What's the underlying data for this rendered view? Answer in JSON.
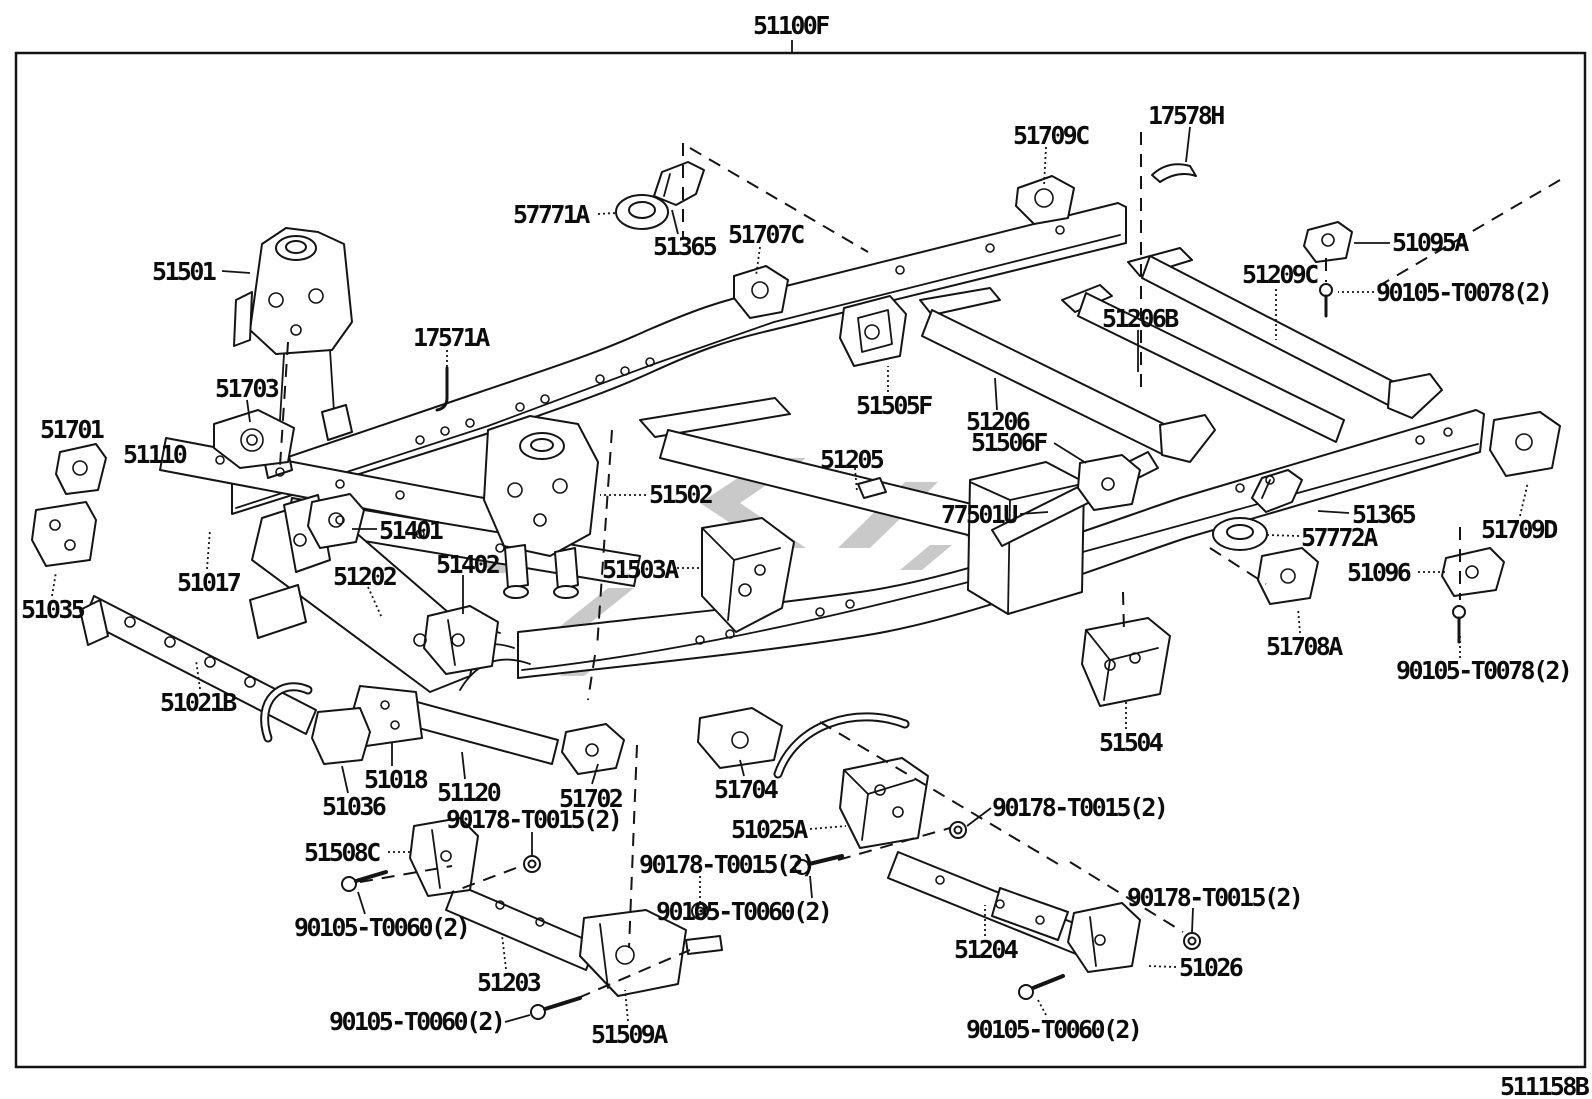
{
  "doc": {
    "assembly_label": "51100F",
    "sheet_code": "511158B",
    "type": "parts-diagram",
    "subject": "vehicle frame assembly exploded view"
  },
  "colors": {
    "line": "#141414",
    "background": "#ffffff",
    "watermark": "#c9c9c9"
  },
  "labels": [
    {
      "text": "17578H",
      "x": 1148,
      "y": 103
    },
    {
      "text": "51709C",
      "x": 1013,
      "y": 123
    },
    {
      "text": "57771A",
      "x": 513,
      "y": 202
    },
    {
      "text": "51365",
      "x": 653,
      "y": 234
    },
    {
      "text": "51707C",
      "x": 728,
      "y": 222
    },
    {
      "text": "51095A",
      "x": 1392,
      "y": 230
    },
    {
      "text": "51209C",
      "x": 1242,
      "y": 262
    },
    {
      "text": "90105-T0078(2)",
      "x": 1376,
      "y": 280
    },
    {
      "text": "51206B",
      "x": 1102,
      "y": 306
    },
    {
      "text": "51501",
      "x": 152,
      "y": 259
    },
    {
      "text": "17571A",
      "x": 413,
      "y": 325
    },
    {
      "text": "51703",
      "x": 215,
      "y": 376
    },
    {
      "text": "51505F",
      "x": 856,
      "y": 393
    },
    {
      "text": "51206",
      "x": 966,
      "y": 409
    },
    {
      "text": "51506F",
      "x": 971,
      "y": 430
    },
    {
      "text": "51701",
      "x": 40,
      "y": 417
    },
    {
      "text": "51110",
      "x": 123,
      "y": 442
    },
    {
      "text": "51205",
      "x": 820,
      "y": 447
    },
    {
      "text": "51502",
      "x": 649,
      "y": 482
    },
    {
      "text": "51401",
      "x": 379,
      "y": 518
    },
    {
      "text": "77501U",
      "x": 941,
      "y": 502
    },
    {
      "text": "51365",
      "x": 1352,
      "y": 502
    },
    {
      "text": "51709D",
      "x": 1481,
      "y": 517
    },
    {
      "text": "57772A",
      "x": 1301,
      "y": 525
    },
    {
      "text": "51017",
      "x": 177,
      "y": 570
    },
    {
      "text": "51402",
      "x": 436,
      "y": 552
    },
    {
      "text": "51503A",
      "x": 602,
      "y": 557
    },
    {
      "text": "51096",
      "x": 1347,
      "y": 560
    },
    {
      "text": "51035",
      "x": 21,
      "y": 597
    },
    {
      "text": "51202",
      "x": 333,
      "y": 564
    },
    {
      "text": "51708A",
      "x": 1266,
      "y": 634
    },
    {
      "text": "90105-T0078(2)",
      "x": 1396,
      "y": 658
    },
    {
      "text": "51021B",
      "x": 160,
      "y": 690
    },
    {
      "text": "51504",
      "x": 1099,
      "y": 730
    },
    {
      "text": "51018",
      "x": 364,
      "y": 767
    },
    {
      "text": "51120",
      "x": 437,
      "y": 780
    },
    {
      "text": "51702",
      "x": 559,
      "y": 786
    },
    {
      "text": "51704",
      "x": 714,
      "y": 777
    },
    {
      "text": "51036",
      "x": 322,
      "y": 794
    },
    {
      "text": "90178-T0015(2)",
      "x": 446,
      "y": 807
    },
    {
      "text": "51025A",
      "x": 731,
      "y": 817
    },
    {
      "text": "90178-T0015(2)",
      "x": 992,
      "y": 795
    },
    {
      "text": "51508C",
      "x": 304,
      "y": 840
    },
    {
      "text": "90178-T0015(2)",
      "x": 639,
      "y": 852
    },
    {
      "text": "90105-T0060(2)",
      "x": 656,
      "y": 899
    },
    {
      "text": "90178-T0015(2)",
      "x": 1127,
      "y": 885
    },
    {
      "text": "90105-T0060(2)",
      "x": 294,
      "y": 915
    },
    {
      "text": "51204",
      "x": 954,
      "y": 937
    },
    {
      "text": "51026",
      "x": 1179,
      "y": 955
    },
    {
      "text": "51203",
      "x": 477,
      "y": 970
    },
    {
      "text": "90105-T0060(2)",
      "x": 329,
      "y": 1009
    },
    {
      "text": "51509A",
      "x": 591,
      "y": 1022
    },
    {
      "text": "90105-T0060(2)",
      "x": 966,
      "y": 1017
    }
  ]
}
